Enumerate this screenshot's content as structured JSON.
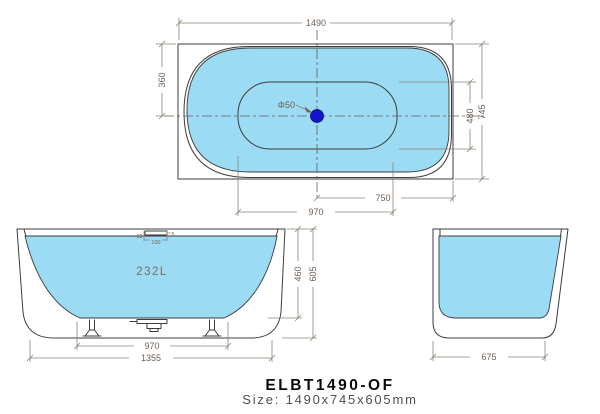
{
  "title": {
    "model": "ELBT1490-OF",
    "size_line": "Size: 1490x745x605mm"
  },
  "colors": {
    "water": "#9CDBF4",
    "drain": "#1414CC",
    "drawing_line": "#3c3c3c",
    "dimension_line": "#8d8277",
    "dimension_text": "#6f6156"
  },
  "views": {
    "top": {
      "label": "top-view",
      "drain_diameter": "Φ50",
      "dims": {
        "overall_length": "1490",
        "end_to_centerline": "360",
        "inner_width": "480",
        "overall_width": "745",
        "center_to_back": "750",
        "inner_length": "970"
      }
    },
    "front": {
      "label": "front-view",
      "capacity": "232L",
      "dims": {
        "overflow_height": "60",
        "overflow_width": "100",
        "overflow_gap": "5",
        "inner_depth": "460",
        "overall_height": "605",
        "feet_span": "970",
        "base_length": "1355"
      }
    },
    "side": {
      "label": "side-view",
      "dims": {
        "base_width": "675"
      }
    }
  }
}
